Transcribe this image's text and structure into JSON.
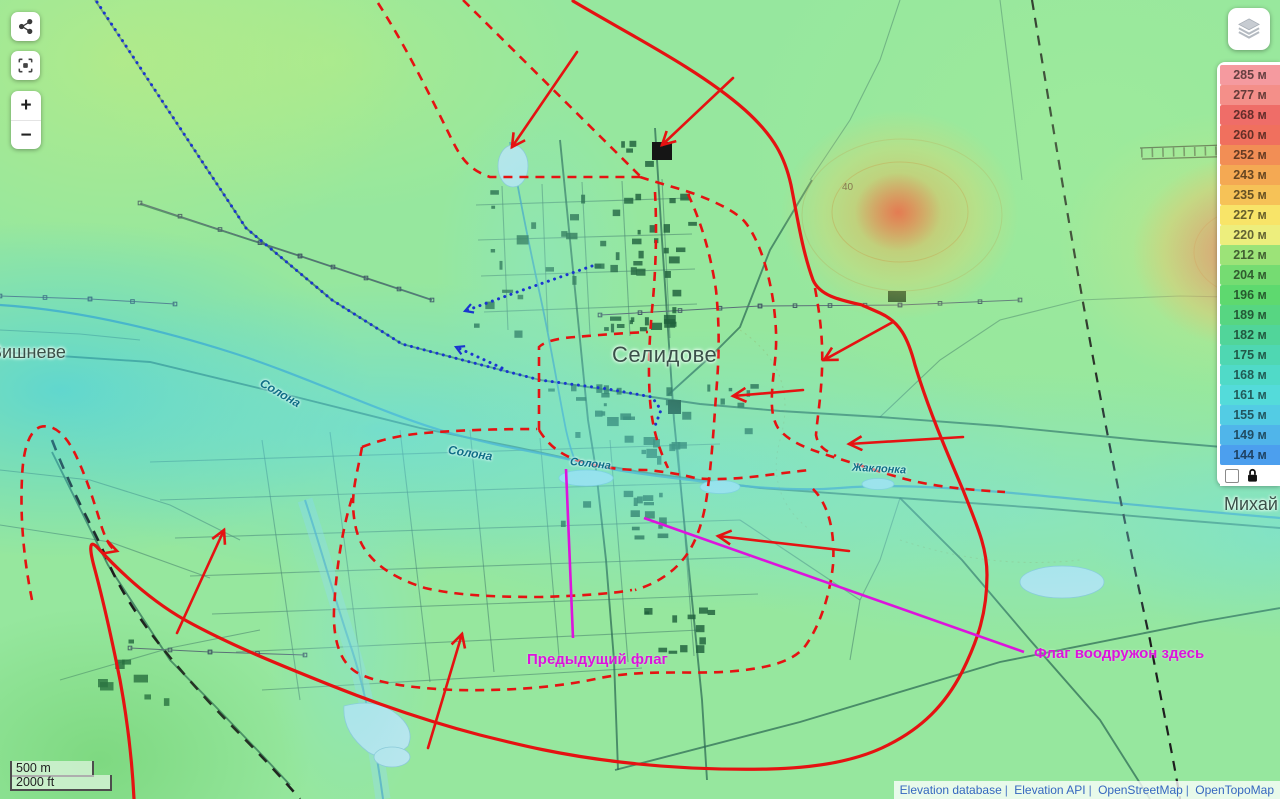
{
  "colors": {
    "front_line": "#e51212",
    "advance_blue": "#1a35cf",
    "annotation": "#dc14dc"
  },
  "controls": {
    "zoom_in": "+",
    "zoom_out": "−"
  },
  "legend": {
    "items": [
      {
        "label": "285 м",
        "color": "#f59a9f"
      },
      {
        "label": "277 м",
        "color": "#f48f89"
      },
      {
        "label": "268 м",
        "color": "#ef6d68"
      },
      {
        "label": "260 м",
        "color": "#f0705e"
      },
      {
        "label": "252 м",
        "color": "#f28e55"
      },
      {
        "label": "243 м",
        "color": "#f4a953"
      },
      {
        "label": "235 м",
        "color": "#f6c257"
      },
      {
        "label": "227 м",
        "color": "#f8e468"
      },
      {
        "label": "220 м",
        "color": "#edee7d"
      },
      {
        "label": "212 м",
        "color": "#9ce378"
      },
      {
        "label": "204 м",
        "color": "#75dc72"
      },
      {
        "label": "196 м",
        "color": "#5ed96f"
      },
      {
        "label": "189 м",
        "color": "#57d682"
      },
      {
        "label": "182 м",
        "color": "#51d59a"
      },
      {
        "label": "175 м",
        "color": "#4fd7b2"
      },
      {
        "label": "168 м",
        "color": "#50dac8"
      },
      {
        "label": "161 м",
        "color": "#54dbda"
      },
      {
        "label": "155 м",
        "color": "#53cce4"
      },
      {
        "label": "149 м",
        "color": "#50b5ea"
      },
      {
        "label": "144 м",
        "color": "#4c9fee"
      }
    ]
  },
  "scale": {
    "metric": "500 m",
    "imperial": "2000 ft"
  },
  "attribution": {
    "separator": "|",
    "items": [
      "Elevation database",
      "Elevation API",
      "OpenStreetMap",
      "OpenTopoMap"
    ]
  },
  "map_labels": {
    "selydove": "Селидове",
    "vyshneve": "Вишневе",
    "mykhailivka": "Михай",
    "solona_a": "Солона",
    "solona_b": "Солона",
    "solona_c": "Солона",
    "zhaklonka": "Жаклонка",
    "contour": "40"
  },
  "annotations": {
    "previous_flag": "Предыдущий флаг",
    "flag_here": "Флаг воодружон здесь"
  }
}
